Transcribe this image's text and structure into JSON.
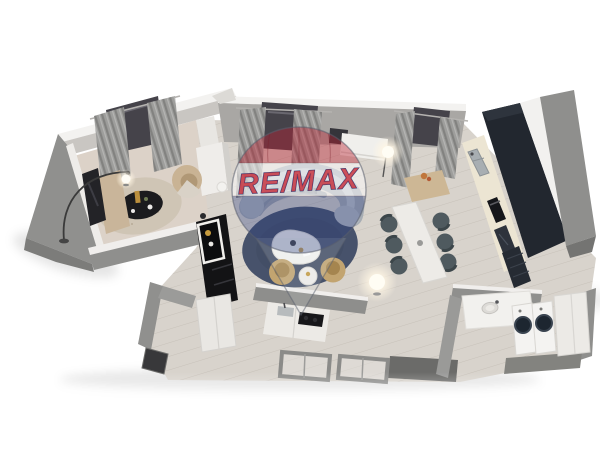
{
  "scene": {
    "description": "3D rendered top-down floor plan of an apartment",
    "watermark": {
      "brand": "RE/MAX",
      "type": "hot-air-balloon-logo",
      "colors": {
        "balloon_top": "#BB202F",
        "balloon_band": "#FFFFFF",
        "balloon_bottom": "#2C3E82",
        "text_fill": "#C6303C",
        "text_outline": "#20306E"
      }
    },
    "palette": {
      "background": "#FFFFFF",
      "walls_outer": "#8F8F8D",
      "walls_top": "#F2F1EF",
      "floor": "#D8D3CC",
      "tv_room_floor": "#DCD2C8",
      "kitchen_cabinets": "#22272F",
      "countertop": "#ECE5D3",
      "sofa": "#A7ADB4",
      "living_rug": "#47526B",
      "tv_room_rug": "#CFC5B5",
      "accent_tan": "#C2A470",
      "dining_chairs": "#4F5A5F",
      "curtains": "#9E9E9C"
    },
    "rooms": [
      {
        "name": "tv-lounge",
        "furniture": [
          "tv",
          "media-sideboard",
          "arc-floor-lamp",
          "ball-table-lamp",
          "round-rug",
          "black-coffee-table",
          "curved-armchair",
          "curtained-window"
        ]
      },
      {
        "name": "living-area",
        "furniture": [
          "curved-sofa",
          "round-blue-rug",
          "organic-coffee-table",
          "tan-armchair",
          "tan-armchair",
          "round-side-table",
          "black-etagere",
          "glowing-floor-lamp",
          "curtained-window",
          "wall-console"
        ]
      },
      {
        "name": "dining-area",
        "furniture": [
          "dining-table",
          "dining-chair-x6",
          "console-with-flowers",
          "glowing-floor-lamp"
        ]
      },
      {
        "name": "kitchen",
        "furniture": [
          "tall-cabinet-column",
          "cabinet-run",
          "sink",
          "built-in-oven",
          "glass-cabinet",
          "drawer-unit",
          "peninsula-counter",
          "cooktop",
          "curtained-window"
        ]
      },
      {
        "name": "hallway",
        "furniture": [
          "wardrobe",
          "entry-door",
          "door-frame",
          "door-frame"
        ]
      },
      {
        "name": "bathroom",
        "furniture": [
          "sink-counter",
          "basin",
          "partition-wall"
        ]
      },
      {
        "name": "laundry",
        "furniture": [
          "washing-machine",
          "washing-machine",
          "storage-cabinet"
        ]
      }
    ]
  }
}
